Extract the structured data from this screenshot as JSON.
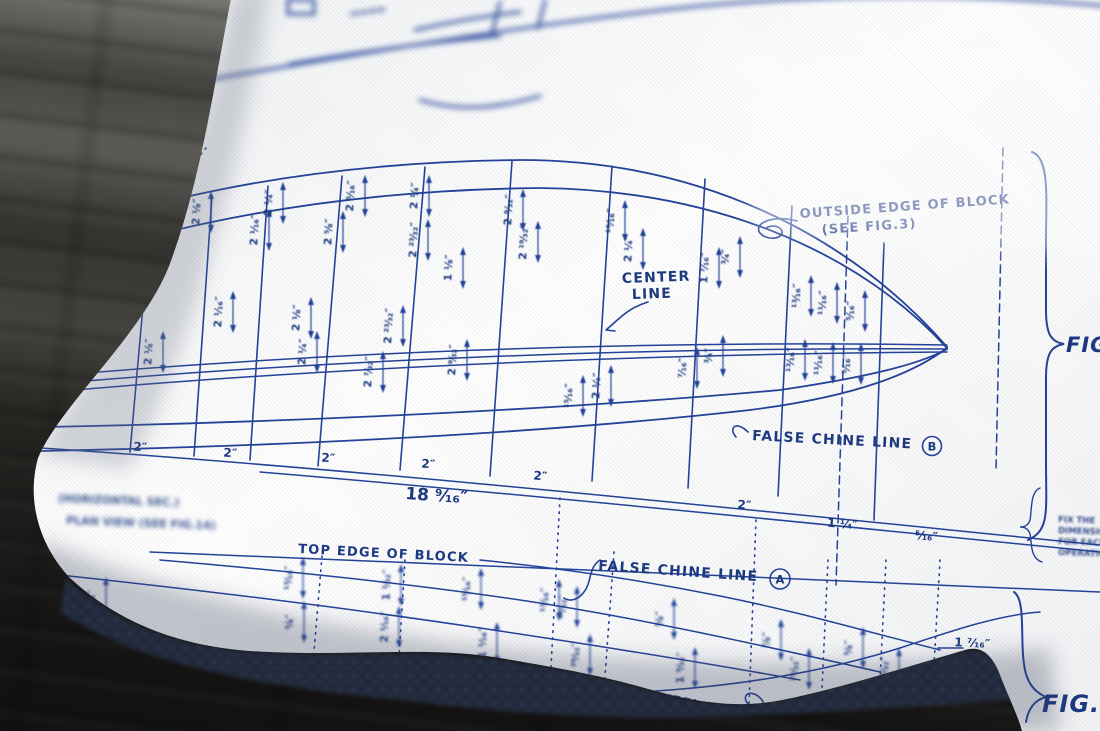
{
  "pillow_print": {
    "ink": "#24439a",
    "callouts": {
      "outside_edge_l1": "OUTSIDE EDGE OF BLOCK",
      "outside_edge_l2": "(SEE FIG.3)",
      "center_l1": "CENTER",
      "center_l2": "LINE",
      "false_chine": "FALSE CHINE LINE",
      "mark_b": "B",
      "mark_a": "A",
      "top_edge": "TOP EDGE OF BLOCK",
      "keel": "KEEL LINE"
    },
    "figure_labels": {
      "right": "FIG",
      "bottom": "FIG.2"
    },
    "notes": {
      "left_l1": "(HORIZONTAL SEC.)",
      "left_l2": "PLAN VIEW (SEE FIG.14)",
      "side_lines": [
        "FIX THE",
        "DIMENSIONS",
        "FOR EACH",
        "OPERATION"
      ]
    },
    "overall_dimension": "18 9/16\"",
    "station_spacing_labels": [
      {
        "t": "2\"",
        "x": 140,
        "y": 451,
        "r": 4
      },
      {
        "t": "2\"",
        "x": 230,
        "y": 457,
        "r": 4
      },
      {
        "t": "2\"",
        "x": 328,
        "y": 462,
        "r": 4
      },
      {
        "t": "2\"",
        "x": 428,
        "y": 468,
        "r": 4
      },
      {
        "t": "2\"",
        "x": 540,
        "y": 480,
        "r": 5
      },
      {
        "t": "2\"",
        "x": 744,
        "y": 509,
        "r": 5
      },
      {
        "t": "1 1/4\"",
        "x": 842,
        "y": 528,
        "r": 5
      },
      {
        "t": "5/16\"",
        "x": 926,
        "y": 540,
        "r": 5
      },
      {
        "t": "1 7/16\"",
        "x": 972,
        "y": 647,
        "r": 3
      }
    ],
    "dimension_labels": [
      {
        "t": "2 1/8\"",
        "x": 152,
        "y": 352
      },
      {
        "t": "2 1/8\"",
        "x": 200,
        "y": 212
      },
      {
        "t": "2 1/16\"",
        "x": 222,
        "y": 312
      },
      {
        "t": "2 1/16\"",
        "x": 258,
        "y": 230
      },
      {
        "t": "2 1/4\"",
        "x": 272,
        "y": 203
      },
      {
        "t": "2 1/8\"",
        "x": 300,
        "y": 318
      },
      {
        "t": "2 1/4\"",
        "x": 306,
        "y": 352
      },
      {
        "t": "2 5/8\"",
        "x": 332,
        "y": 232
      },
      {
        "t": "2 5/16\"",
        "x": 354,
        "y": 196
      },
      {
        "t": "2 7/32\"",
        "x": 372,
        "y": 372
      },
      {
        "t": "2 23/32\"",
        "x": 392,
        "y": 326
      },
      {
        "t": "2 1/4\"",
        "x": 418,
        "y": 196
      },
      {
        "t": "2 23/32\"",
        "x": 417,
        "y": 240
      },
      {
        "t": "1 1/8\"",
        "x": 452,
        "y": 268
      },
      {
        "t": "2 9/32\"",
        "x": 456,
        "y": 360
      },
      {
        "t": "2 9/32\"",
        "x": 512,
        "y": 210
      },
      {
        "t": "2 19/32\"",
        "x": 527,
        "y": 242
      },
      {
        "t": "15/16\"",
        "x": 572,
        "y": 396
      },
      {
        "t": "2 1/4\"",
        "x": 600,
        "y": 386
      },
      {
        "t": "15/16\"",
        "x": 614,
        "y": 221
      },
      {
        "t": "2 1/4\"",
        "x": 632,
        "y": 249
      },
      {
        "t": "7/16\"",
        "x": 686,
        "y": 368
      },
      {
        "t": "3/4\"",
        "x": 712,
        "y": 356
      },
      {
        "t": "1 7/16\"",
        "x": 708,
        "y": 268
      },
      {
        "t": "3/4\"",
        "x": 729,
        "y": 257
      },
      {
        "t": "13/16\"",
        "x": 800,
        "y": 296
      },
      {
        "t": "11/16\"",
        "x": 826,
        "y": 303
      },
      {
        "t": "5/16\"",
        "x": 854,
        "y": 311
      },
      {
        "t": "13/16\"",
        "x": 794,
        "y": 360
      },
      {
        "t": "11/16\"",
        "x": 822,
        "y": 363
      },
      {
        "t": "5/16\"",
        "x": 850,
        "y": 364
      }
    ],
    "bottom_dimension_labels": [
      {
        "t": "3/4\"",
        "x": 95,
        "y": 598
      },
      {
        "t": "13/16\"",
        "x": 292,
        "y": 578
      },
      {
        "t": "5/8\"",
        "x": 293,
        "y": 622
      },
      {
        "t": "1 1/32\"",
        "x": 390,
        "y": 585
      },
      {
        "t": "2 1/16\"",
        "x": 388,
        "y": 627
      },
      {
        "t": "15/16\"",
        "x": 470,
        "y": 589
      },
      {
        "t": "1 1/16\"",
        "x": 486,
        "y": 643
      },
      {
        "t": "13/16\"",
        "x": 548,
        "y": 600
      },
      {
        "t": "13/32\"",
        "x": 566,
        "y": 607
      },
      {
        "t": "29/32\"",
        "x": 579,
        "y": 655
      },
      {
        "t": "5/8\"",
        "x": 663,
        "y": 619
      },
      {
        "t": "1 9/32\"",
        "x": 684,
        "y": 668
      },
      {
        "t": "7/8\"",
        "x": 770,
        "y": 640
      },
      {
        "t": "25/32\"",
        "x": 798,
        "y": 669
      },
      {
        "t": "5/8\"",
        "x": 852,
        "y": 648
      },
      {
        "t": "25/32\"",
        "x": 888,
        "y": 669
      }
    ]
  }
}
